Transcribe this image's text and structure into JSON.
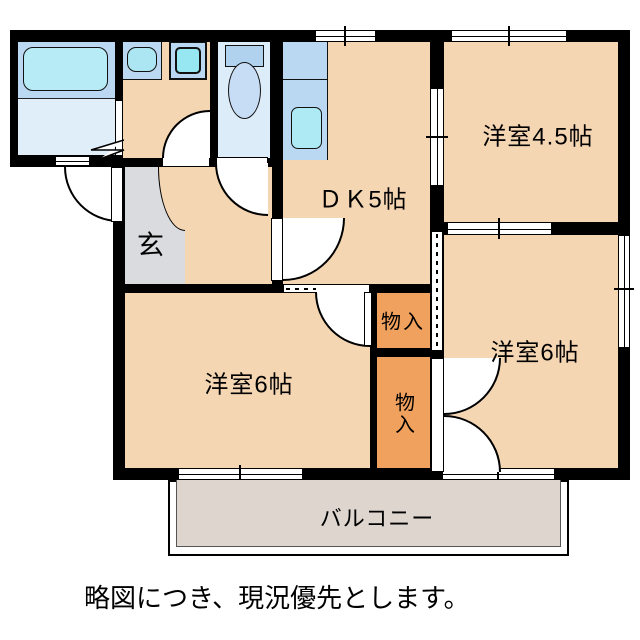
{
  "rooms": {
    "dk": {
      "label": "ＤＫ5帖"
    },
    "western_45": {
      "label": "洋室4.5帖"
    },
    "western_6_right": {
      "label": "洋室6帖"
    },
    "western_6_left": {
      "label": "洋室6帖"
    },
    "entrance": {
      "label": "玄"
    },
    "closet_upper": {
      "label": "物入"
    },
    "closet_lower": {
      "label": "物入"
    },
    "balcony": {
      "label": "バルコニー"
    }
  },
  "caption": "略図につき、現況優先とします。",
  "colors": {
    "wall": "#000000",
    "floor": "#f5d6b3",
    "closet": "#f0a15d",
    "entry": "#d9dbde",
    "balcony": "#ded5ce",
    "bath_upper": "#bad8f1",
    "bath_lower": "#e0eefa",
    "tub": "#b7ecf6",
    "toilet_floor": "#ddecf9",
    "fixture_blue": "#bad8f1",
    "basin": "#abe6f2",
    "washer": "#97e7f3",
    "kitchen_sink": "#aeeaf4",
    "toilet_tank": "#b0d2ee",
    "toilet_bowl": "#c7ddf5"
  }
}
